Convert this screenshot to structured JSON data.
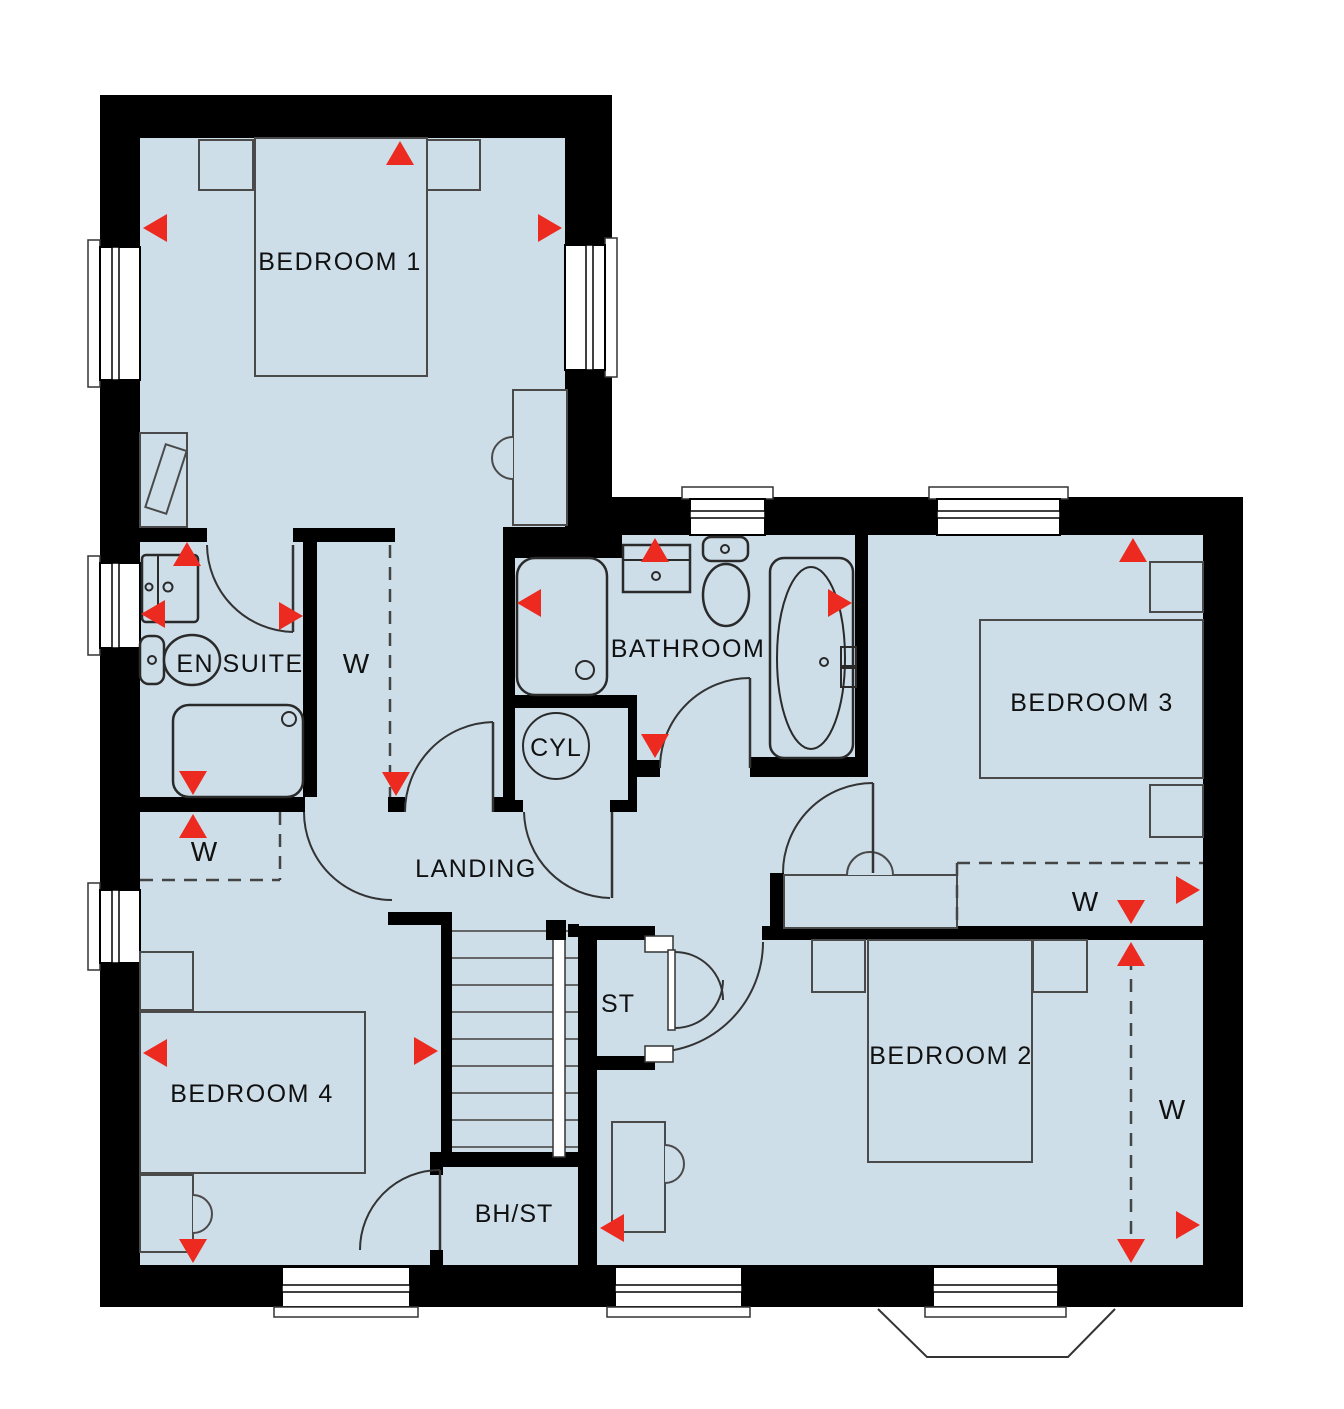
{
  "title": "First floor plan",
  "labels": {
    "bedroom1": "BEDROOM 1",
    "bedroom2": "BEDROOM 2",
    "bedroom3": "BEDROOM 3",
    "bedroom4": "BEDROOM 4",
    "ensuite": "EN SUITE",
    "bathroom": "BATHROOM",
    "landing": "LANDING",
    "cylinder": "CYL",
    "store": "ST",
    "bulkhead_store": "BH/ST",
    "wardrobe": "W"
  },
  "colors": {
    "floor": "#cddee9",
    "wall": "#000000",
    "arrow": "#ec2a1f",
    "furniture_line": "#4a4a4a",
    "fixture_line": "#2a2a2a",
    "door_line": "#333333",
    "text": "#111111"
  }
}
